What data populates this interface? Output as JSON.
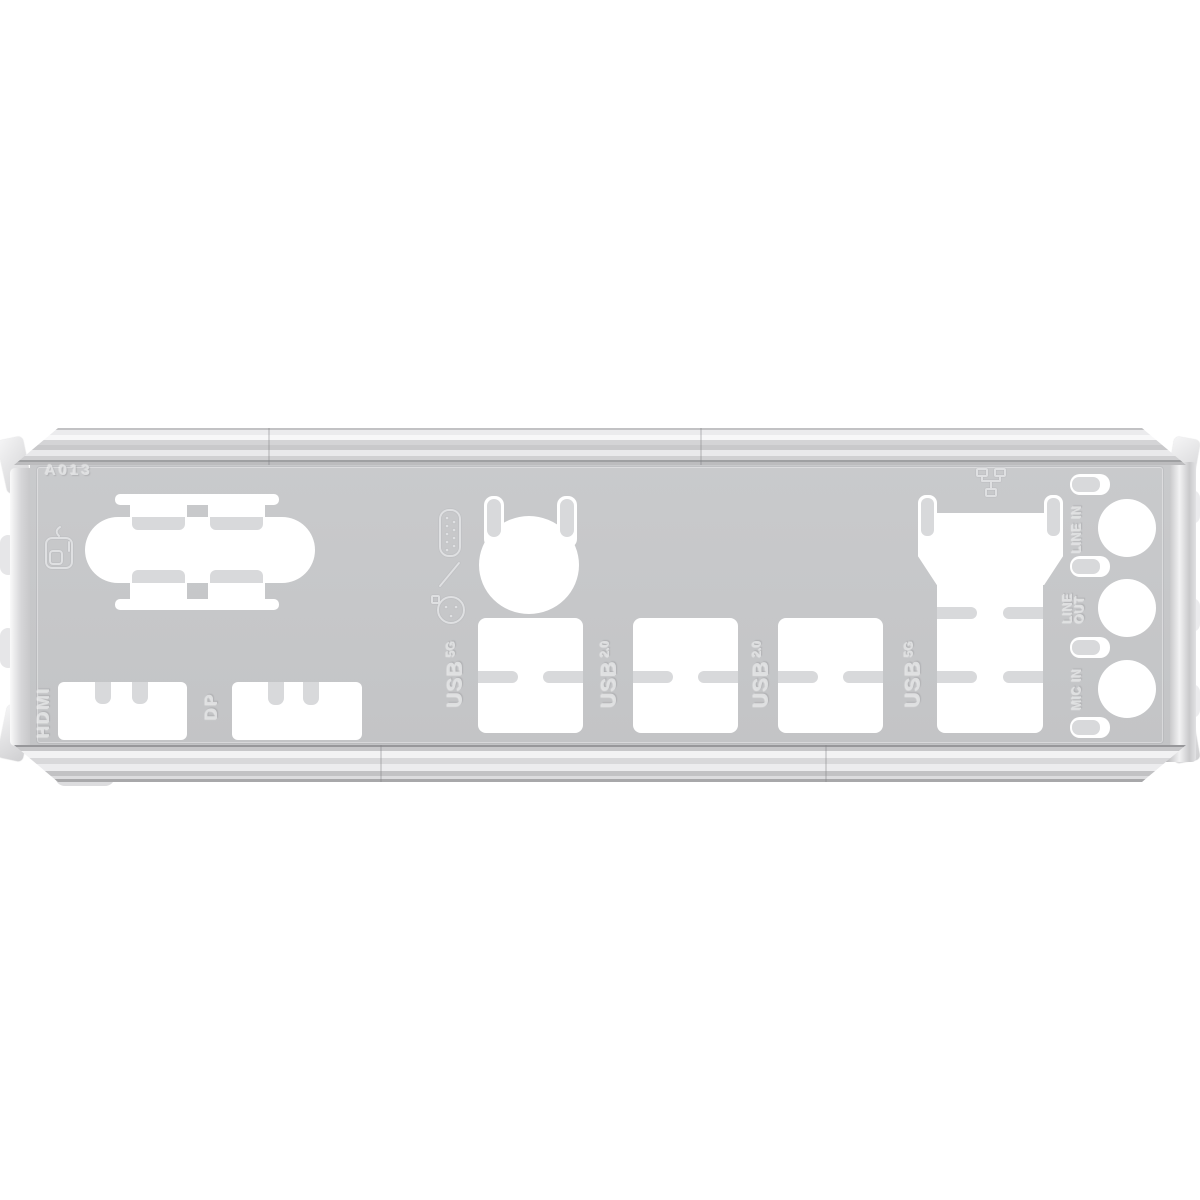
{
  "image": {
    "background_color": "#ffffff"
  },
  "shield": {
    "plate_color": "#c6c7c9",
    "bent_tab_color": "#d8d9db",
    "emboss_color": "#dfe0e2",
    "stamp": "A013",
    "ports": {
      "ps2_knockout": {
        "icon": "ps2-keyboard-mouse-icon"
      },
      "com_ps2": {
        "icons": [
          "com-port-icon",
          "slash",
          "ps2-mini-din-icon"
        ]
      },
      "hdmi": {
        "label": "HDMI"
      },
      "displayport": {
        "label": "DP"
      },
      "usb_blocks": [
        {
          "label": "USB",
          "speed": "5G"
        },
        {
          "label": "USB",
          "speed": "2.0"
        },
        {
          "label": "USB",
          "speed": "2.0"
        },
        {
          "label": "USB",
          "speed": "5G"
        }
      ],
      "lan": {
        "icon": "lan-icon"
      },
      "audio_jacks": [
        {
          "line1": "LINE IN",
          "line2": ""
        },
        {
          "line1": "LINE",
          "line2": "OUT"
        },
        {
          "line1": "MIC IN",
          "line2": ""
        }
      ]
    }
  }
}
